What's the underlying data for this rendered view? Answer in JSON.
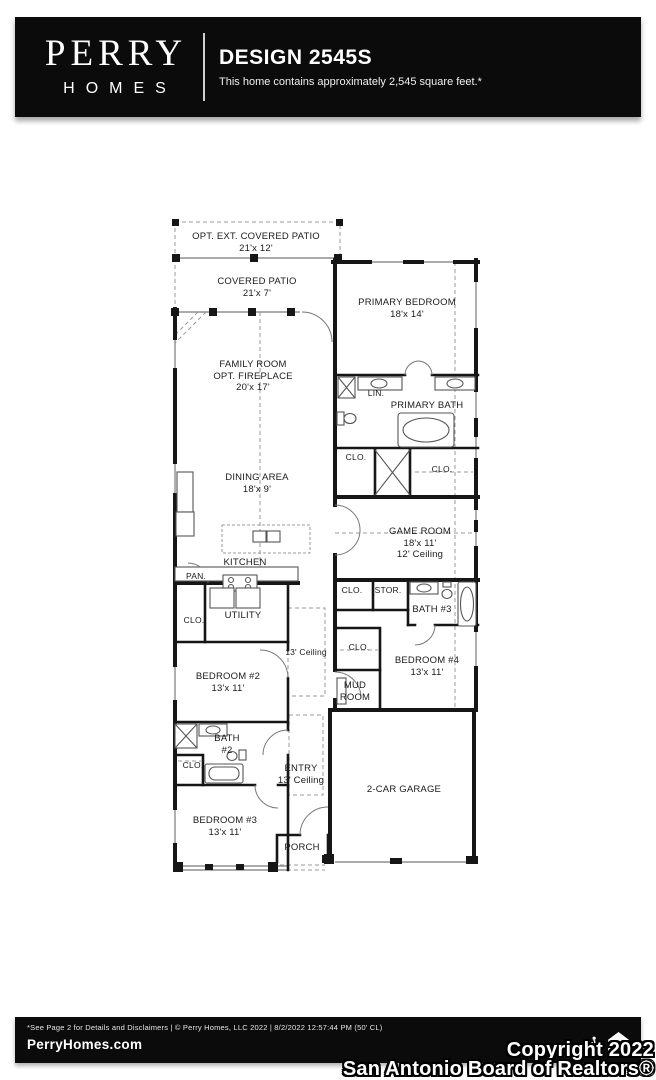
{
  "header": {
    "brand_name": "PERRY",
    "brand_sub": "HOMES",
    "title": "DESIGN 2545S",
    "subtitle": "This home contains approximately 2,545 square feet.*"
  },
  "rooms": {
    "opt_ext_patio": {
      "name": "OPT. EXT. COVERED PATIO",
      "dims": "21'x 12'"
    },
    "covered_patio": {
      "name": "COVERED PATIO",
      "dims": "21'x 7'"
    },
    "primary_bedroom": {
      "name": "PRIMARY BEDROOM",
      "dims": "18'x 14'"
    },
    "family_room": {
      "name": "FAMILY ROOM",
      "name2": "OPT. FIREPLACE",
      "dims": "20'x 17'"
    },
    "lin": {
      "name": "LIN."
    },
    "primary_bath": {
      "name": "PRIMARY BATH"
    },
    "clo_primary_left": {
      "name": "CLO."
    },
    "clo_primary_right": {
      "name": "CLO."
    },
    "dining": {
      "name": "DINING AREA",
      "dims": "18'x 9'"
    },
    "game_room": {
      "name": "GAME ROOM",
      "dims": "18'x 11'",
      "ceiling": "12' Ceiling"
    },
    "kitchen": {
      "name": "KITCHEN"
    },
    "pantry": {
      "name": "PAN."
    },
    "clo_hall": {
      "name": "CLO."
    },
    "stor": {
      "name": "STOR."
    },
    "bath3": {
      "name": "BATH #3"
    },
    "utility": {
      "name": "UTILITY"
    },
    "clo_utility": {
      "name": "CLO."
    },
    "hall_ceiling": {
      "name": "13' Ceiling"
    },
    "clo_bed4": {
      "name": "CLO."
    },
    "bedroom4": {
      "name": "BEDROOM #4",
      "dims": "13'x 11'"
    },
    "bedroom2": {
      "name": "BEDROOM #2",
      "dims": "13'x 11'"
    },
    "mud_room": {
      "line1": "MUD",
      "line2": "ROOM"
    },
    "bath2": {
      "line1": "BATH",
      "line2": "#2"
    },
    "clo_bed3": {
      "name": "CLO."
    },
    "entry": {
      "name": "ENTRY",
      "ceiling": "13' Ceiling"
    },
    "garage": {
      "name": "2-CAR GARAGE"
    },
    "bedroom3": {
      "name": "BEDROOM #3",
      "dims": "13'x 11'"
    },
    "porch": {
      "name": "PORCH"
    }
  },
  "footer": {
    "disclaimer": "*See Page 2 for Details and Disclaimers  |  © Perry Homes, LLC 2022  |  8/2/2022 12:57:44 PM  (50' CL)",
    "website": "PerryHomes.com",
    "page": "Page 1 of 2",
    "icons": [
      "wheelchair-accessibility",
      "equal-housing-opportunity"
    ]
  },
  "watermark": {
    "line1": "Copyright 2022",
    "line2": "San Antonio Board of Realtors®"
  },
  "colors": {
    "bar_bg": "#0b0b0b",
    "bar_text": "#ffffff",
    "wall": "#161616",
    "thin_line": "#6b6b6b",
    "dashed_line": "#9a9a9a",
    "label_text": "#1b1b1b"
  }
}
